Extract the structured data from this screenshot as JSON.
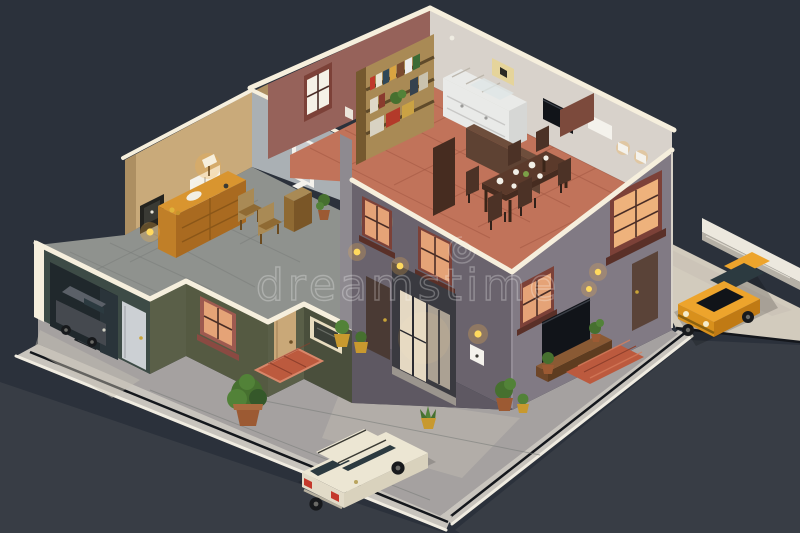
{
  "watermark": {
    "text": "dreamstime"
  },
  "palette": {
    "bg": "#2b313b",
    "street": "#383d45",
    "sidewalk": "#c8c4bd",
    "sidewalk_edge": "#f0ece1",
    "courtyard": "#a5a1a0",
    "courtyard_lit": "#c6c0b4",
    "driveway": "#d2cbbd",
    "curb_wall": "#ece8de",
    "curb_side": "#b5b0a6",
    "trim": "#f6efdd",
    "office_wall": "#c9aa7a",
    "office_wall_shade": "#ad8f62",
    "office_floor": "#8f928e",
    "partition": "#aab0b4",
    "brown_wall": "#96625a",
    "back_wall": "#d8d2cb",
    "terracotta": "#c1735a",
    "terracotta_line": "#a05541",
    "teal_wall": "#3d4b46",
    "olive_wall": "#555a42",
    "olive_wall2": "#4a4f3c",
    "olive_wall3": "#5a5f48",
    "garage_dark": "#20282c",
    "garage_inner": "#2a343a",
    "door_gray": "#ccd0d4",
    "door_tan": "#c9a878",
    "maroon_frame": "#7c4138",
    "window_warm": "#e5a377",
    "window_warm2": "#eeb27c",
    "window_bright": "#f5f1e6",
    "facade_sw": "#6a636d",
    "facade_sw_dark": "#5e5862",
    "facade_se": "#817a84",
    "wood": "#a98a55",
    "wood_dark": "#6b4a33",
    "counter": "#e9eae8",
    "counter_side": "#d6d7d5",
    "table_brown": "#5b3a2b",
    "table_dark": "#462c20",
    "chair_brown": "#4c3226",
    "sideboard": "#d9952f",
    "sideboard_front": "#c07f28",
    "sideboard_side": "#a96a20",
    "mat_red": "#bc5a3e",
    "mat_red_light": "#d97f5e",
    "lamp_yellow": "#ffd95e",
    "glow_warm": "#f2b04a",
    "car_white": "#ece6d3",
    "car_white_side": "#d9d2bd",
    "car_white_rear": "#e2dbc8",
    "car_dark": "#45494f",
    "car_dark_roof": "#5b6068",
    "car_yellow": "#eda42c",
    "car_yellow_dark": "#d8901c",
    "car_yellow_side": "#c07a14",
    "glass_dark": "#2c3a40",
    "plant_green": "#46702f",
    "plant_dark": "#35582a",
    "plant_light": "#528238",
    "pot_yellow": "#c8992f",
    "pot_terra": "#9c5a33",
    "tail_red": "#c4392c",
    "white": "#f4f2ec",
    "black_panel": "#111419",
    "wheel": "#17191c",
    "hub": "#6a6a66"
  }
}
